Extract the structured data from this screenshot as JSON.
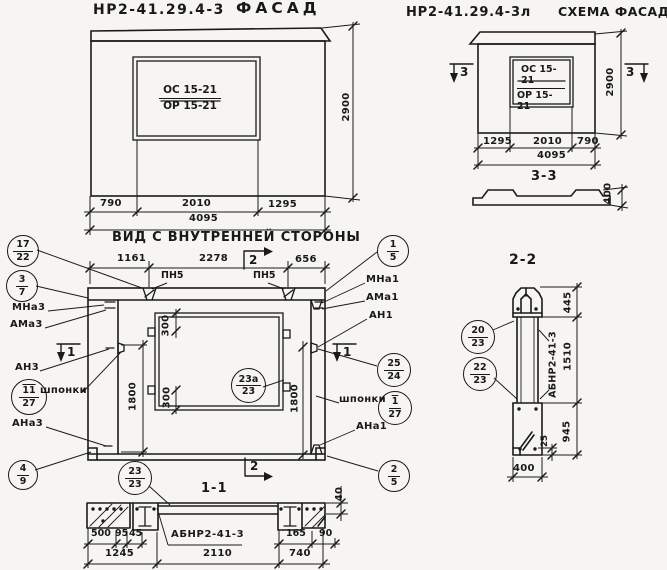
{
  "colors": {
    "ink": "#1a1a1a",
    "paper": "#f6f5f2"
  },
  "titles": {
    "facade_code": "НР2-41.29.4-3",
    "facade_label": "ФАСАД",
    "schema_code": "НР2-41.29.4-3л",
    "schema_label": "СХЕМА ФАСАДА",
    "inner_view": "ВИД С ВНУТРЕННЕЙ СТОРОНЫ",
    "section_1": "1-1",
    "section_2": "2-2",
    "section_3": "3-3"
  },
  "facade": {
    "window_line1": "ОС 15-21",
    "window_line2": "ОР 15-21",
    "dim_height": "2900",
    "dim_left": "790",
    "dim_mid": "2010",
    "dim_right": "1295",
    "dim_total": "4095"
  },
  "schema": {
    "window_line1": "ОС 15-21",
    "window_line2": "ОР 15-21",
    "dim_height": "2900",
    "dim_left": "1295",
    "dim_mid": "2010",
    "dim_right": "790",
    "dim_total": "4095",
    "mark_left": "3",
    "mark_right": "3",
    "profile_dim": "400"
  },
  "main_view": {
    "dim_top_left": "1161",
    "dim_top_mid": "2278",
    "dim_top_right": "656",
    "pn5_left": "ПН5",
    "pn5_right": "ПН5",
    "mark_top": "2",
    "mark_bottom": "2",
    "mark_left": "1",
    "mark_right": "1",
    "label_mna3": "МНа3",
    "label_ama3": "АМа3",
    "label_an3": "АН3",
    "label_shponki_left": "шпонки",
    "label_ana3": "АНа3",
    "label_mna1": "МНа1",
    "label_ama1": "АМа1",
    "label_an1": "АН1",
    "label_shponki_right": "шпонки",
    "label_ana1": "АНа1",
    "dim_300_top": "300",
    "dim_300_bottom": "300",
    "dim_1800_left": "1800",
    "dim_1800_right": "1800"
  },
  "callouts": {
    "c17_22": {
      "top": "17",
      "bottom": "22"
    },
    "c3_7": {
      "top": "3",
      "bottom": "7"
    },
    "c11_27": {
      "top": "11",
      "bottom": "27"
    },
    "c4_9": {
      "top": "4",
      "bottom": "9"
    },
    "c1_5": {
      "top": "1",
      "bottom": "5"
    },
    "c25_24": {
      "top": "25",
      "bottom": "24"
    },
    "c1_27": {
      "top": "1",
      "bottom": "27"
    },
    "c2_5": {
      "top": "2",
      "bottom": "5"
    },
    "c23a_23": {
      "top": "23а",
      "bottom": "23"
    },
    "c23_23": {
      "top": "23",
      "bottom": "23"
    },
    "c20_23": {
      "top": "20",
      "bottom": "23"
    },
    "c22_23": {
      "top": "22",
      "bottom": "23"
    }
  },
  "section_11": {
    "label": "АБНР2-41-3",
    "d500": "500",
    "d95": "95",
    "d45": "45",
    "d165": "165",
    "d90": "90",
    "d1245": "1245",
    "d2110": "2110",
    "d740": "740",
    "d40": "40"
  },
  "section_22": {
    "label": "АБНР2-41-3",
    "d445": "445",
    "d1510": "1510",
    "d945": "945",
    "d25": "25",
    "d400": "400"
  }
}
